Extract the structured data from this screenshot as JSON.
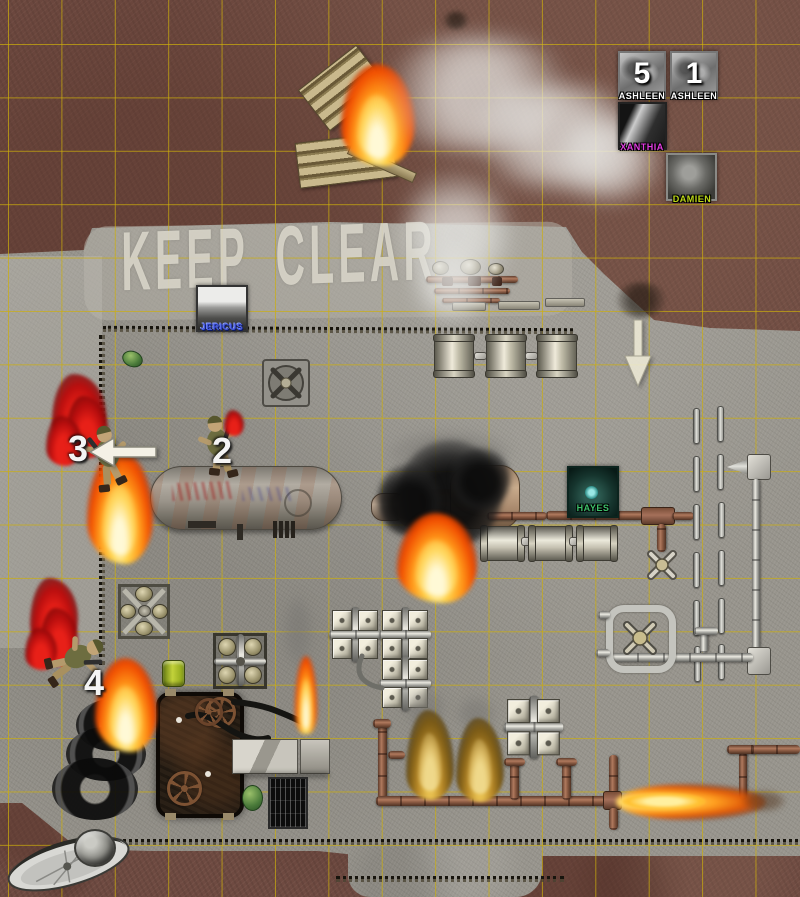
{
  "map": {
    "ground_stencil": {
      "word1": "KEEP",
      "word2": "CLEAR"
    },
    "grid_color": "#cdaf0a",
    "terrain": {
      "dirt": "#6e4a41",
      "concrete": "#97948c"
    },
    "fire_color": "#ff9518"
  },
  "tokens": {
    "ashleen_a": {
      "label": "ASHLEEN",
      "count": "5",
      "label_color": "#ffffff"
    },
    "ashleen_b": {
      "label": "ASHLEEN",
      "count": "1",
      "label_color": "#ffffff"
    },
    "xanthia": {
      "label": "XANTHIA",
      "label_color": "#e23de2"
    },
    "damien": {
      "label": "DAMIEN",
      "label_color": "#bcd818"
    },
    "jericus": {
      "label": "JERICUS",
      "label_color": "#4456e0"
    },
    "hayes": {
      "label": "HAYES",
      "label_color": "#3ec06a"
    }
  },
  "markers": {
    "soldier2": "2",
    "soldier3": "3",
    "soldier4": "4"
  }
}
